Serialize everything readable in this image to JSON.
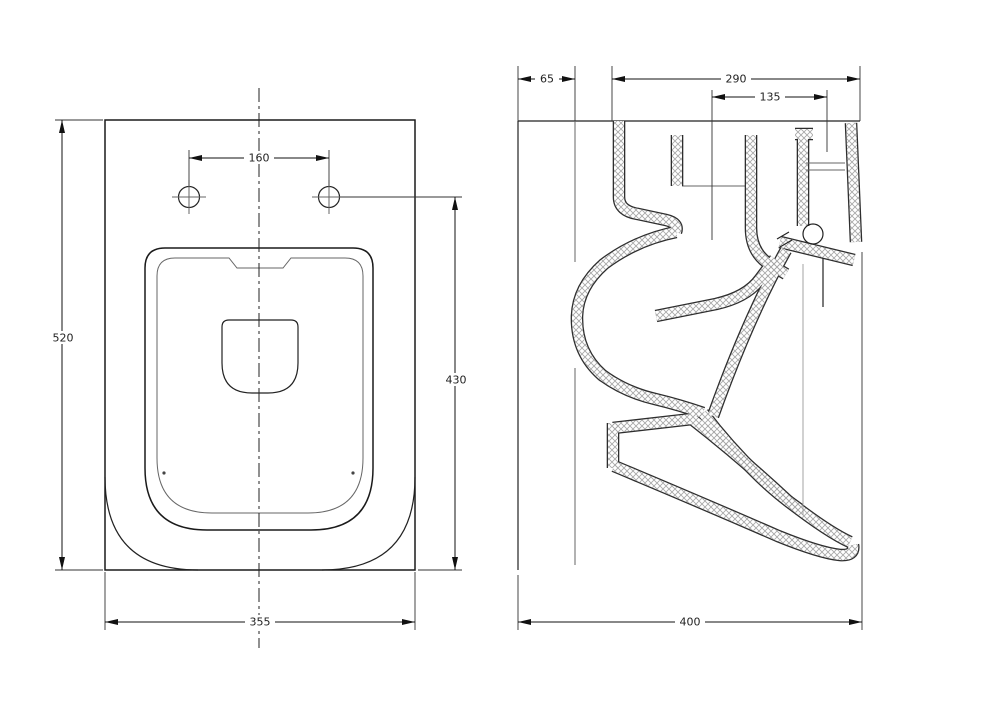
{
  "views": {
    "plan": {
      "name": "plan-view",
      "dims": {
        "bolt_spacing": "160",
        "overall_depth": "520",
        "bolt_to_front": "430",
        "overall_width": "355"
      }
    },
    "section": {
      "name": "section-view",
      "dims": {
        "wall_offset": "65",
        "rim_depth": "290",
        "flush_channel": "135",
        "overall_depth": "400"
      }
    }
  },
  "colors": {
    "ink": "#222222",
    "hatch": "#a8a8a8",
    "background": "#ffffff"
  }
}
